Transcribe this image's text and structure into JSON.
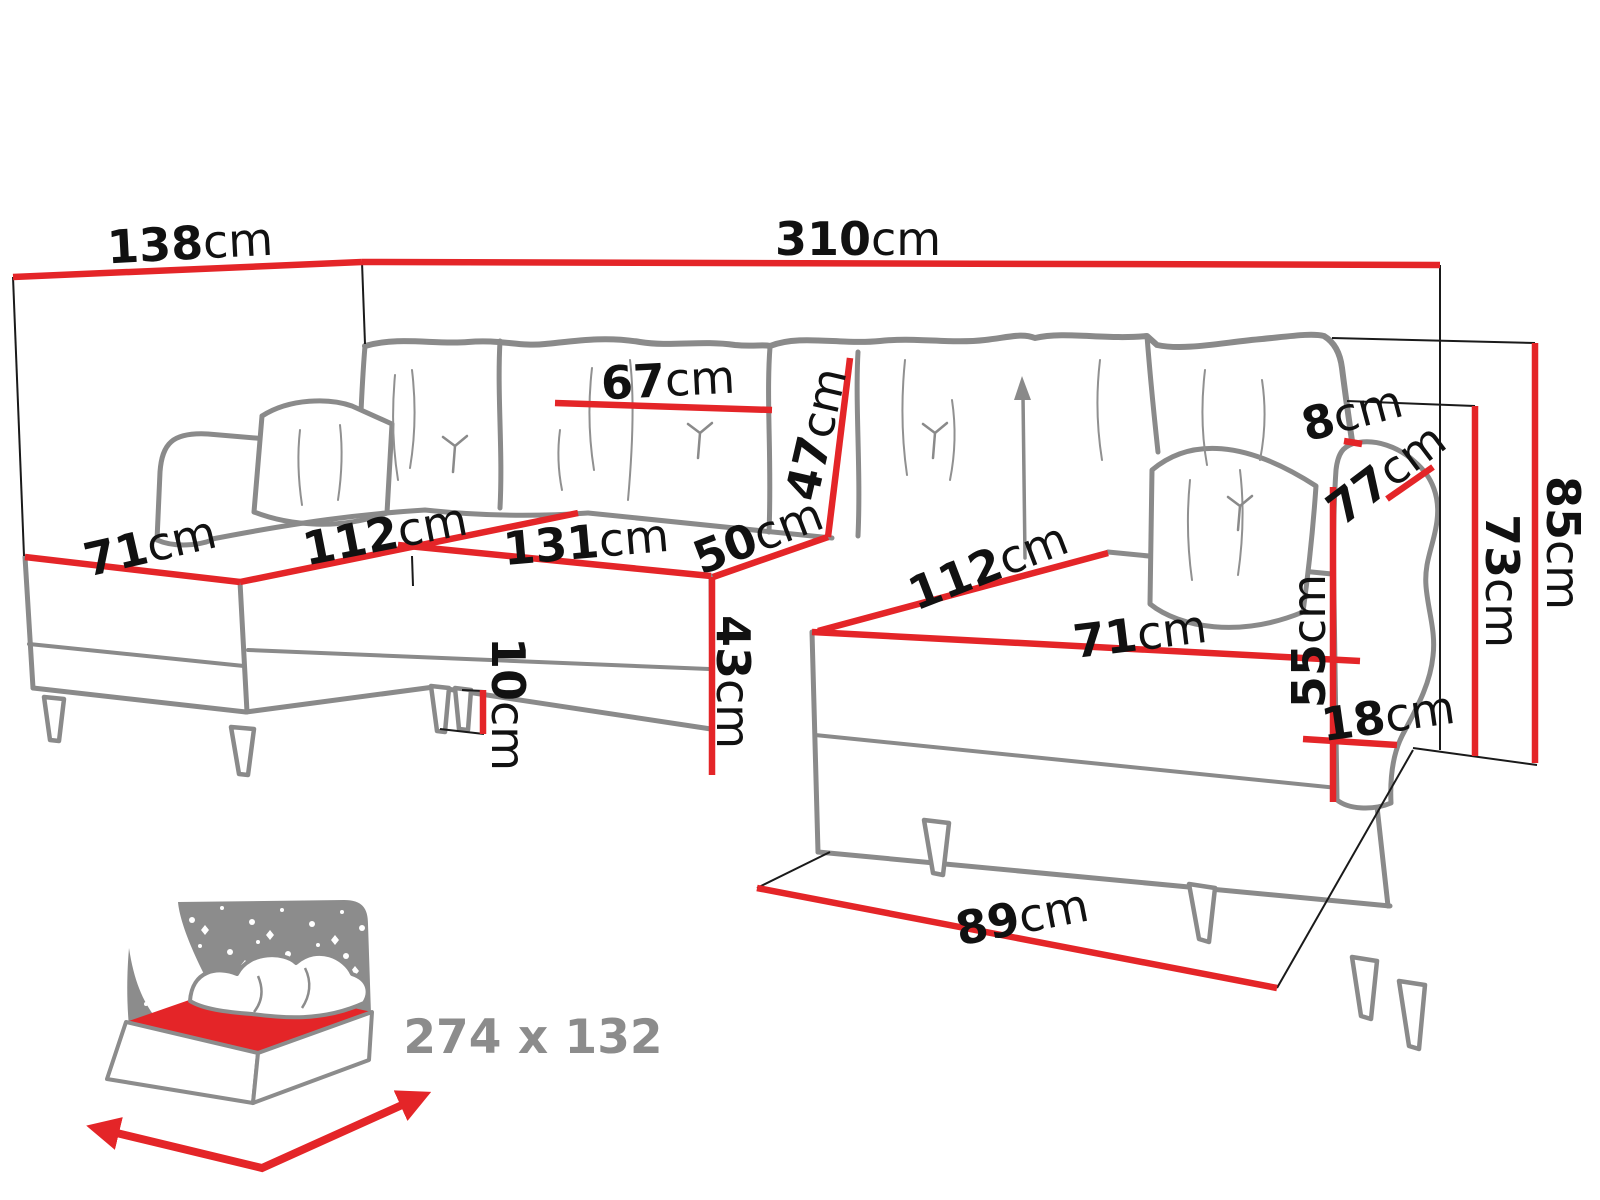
{
  "page": {
    "background": "#ffffff"
  },
  "colors": {
    "red": "#e42528",
    "sofa_gray": "#8a8a8a",
    "label_black": "#111111",
    "icon_gray": "#8c8c8c",
    "thin_black": "#1a1a1a",
    "white": "#ffffff"
  },
  "sleep_icon": {
    "label": "274 x 132"
  },
  "diagram": {
    "label_font_size": 46,
    "labels": [
      {
        "id": "d138",
        "value": "138",
        "unit": "cm",
        "x": 190,
        "y": 243,
        "rot": -3
      },
      {
        "id": "d310",
        "value": "310",
        "unit": "cm",
        "x": 858,
        "y": 239,
        "rot": 0
      },
      {
        "id": "d67",
        "value": "67",
        "unit": "cm",
        "x": 668,
        "y": 380,
        "rot": -3
      },
      {
        "id": "d47",
        "value": "47",
        "unit": "cm",
        "x": 816,
        "y": 434,
        "rot": -77
      },
      {
        "id": "d8",
        "value": "8",
        "unit": "cm",
        "x": 1352,
        "y": 413,
        "rot": -15
      },
      {
        "id": "d77",
        "value": "77",
        "unit": "cm",
        "x": 1386,
        "y": 474,
        "rot": -37
      },
      {
        "id": "d85",
        "value": "85",
        "unit": "cm",
        "x": 1563,
        "y": 543,
        "rot": 90
      },
      {
        "id": "d73",
        "value": "73",
        "unit": "cm",
        "x": 1502,
        "y": 581,
        "rot": 90
      },
      {
        "id": "d55",
        "value": "55",
        "unit": "cm",
        "x": 1309,
        "y": 641,
        "rot": -90
      },
      {
        "id": "d18",
        "value": "18",
        "unit": "cm",
        "x": 1388,
        "y": 716,
        "rot": -8
      },
      {
        "id": "d71-left",
        "value": "71",
        "unit": "cm",
        "x": 150,
        "y": 546,
        "rot": -13
      },
      {
        "id": "d112-left",
        "value": "112",
        "unit": "cm",
        "x": 385,
        "y": 534,
        "rot": -11
      },
      {
        "id": "d131",
        "value": "131",
        "unit": "cm",
        "x": 586,
        "y": 542,
        "rot": -5
      },
      {
        "id": "d50",
        "value": "50",
        "unit": "cm",
        "x": 758,
        "y": 536,
        "rot": -21
      },
      {
        "id": "d43",
        "value": "43",
        "unit": "cm",
        "x": 733,
        "y": 682,
        "rot": 90
      },
      {
        "id": "d10",
        "value": "10",
        "unit": "cm",
        "x": 508,
        "y": 704,
        "rot": 90
      },
      {
        "id": "d112-right",
        "value": "112",
        "unit": "cm",
        "x": 988,
        "y": 566,
        "rot": -21
      },
      {
        "id": "d71-right",
        "value": "71",
        "unit": "cm",
        "x": 1140,
        "y": 634,
        "rot": -7
      },
      {
        "id": "d89",
        "value": "89",
        "unit": "cm",
        "x": 1022,
        "y": 917,
        "rot": -11
      }
    ],
    "red_lines": [
      {
        "id": "l138",
        "x1": 13,
        "y1": 277,
        "x2": 362,
        "y2": 262
      },
      {
        "id": "l310",
        "x1": 362,
        "y1": 262,
        "x2": 1440,
        "y2": 265
      },
      {
        "id": "l85",
        "x1": 1535,
        "y1": 343,
        "x2": 1535,
        "y2": 763
      },
      {
        "id": "l73",
        "x1": 1475,
        "y1": 406,
        "x2": 1475,
        "y2": 756
      },
      {
        "id": "l8",
        "x1": 1344,
        "y1": 441,
        "x2": 1362,
        "y2": 444
      },
      {
        "id": "l77",
        "x1": 1387,
        "y1": 499,
        "x2": 1433,
        "y2": 467
      },
      {
        "id": "l55",
        "x1": 1333,
        "y1": 487,
        "x2": 1333,
        "y2": 802
      },
      {
        "id": "l18",
        "x1": 1303,
        "y1": 739,
        "x2": 1397,
        "y2": 745
      },
      {
        "id": "l71-left",
        "x1": 25,
        "y1": 557,
        "x2": 240,
        "y2": 582
      },
      {
        "id": "l112-left",
        "x1": 240,
        "y1": 582,
        "x2": 578,
        "y2": 513
      },
      {
        "id": "l131",
        "x1": 398,
        "y1": 545,
        "x2": 711,
        "y2": 576
      },
      {
        "id": "l50",
        "x1": 713,
        "y1": 577,
        "x2": 828,
        "y2": 537
      },
      {
        "id": "l47",
        "x1": 850,
        "y1": 358,
        "x2": 828,
        "y2": 537
      },
      {
        "id": "l67",
        "x1": 555,
        "y1": 403,
        "x2": 772,
        "y2": 410
      },
      {
        "id": "l43",
        "x1": 712,
        "y1": 577,
        "x2": 712,
        "y2": 775
      },
      {
        "id": "l10",
        "x1": 483,
        "y1": 690,
        "x2": 483,
        "y2": 734
      },
      {
        "id": "l112-right",
        "x1": 818,
        "y1": 631,
        "x2": 1108,
        "y2": 553
      },
      {
        "id": "l71-right",
        "x1": 812,
        "y1": 632,
        "x2": 1360,
        "y2": 661
      },
      {
        "id": "l89",
        "x1": 757,
        "y1": 888,
        "x2": 1277,
        "y2": 988
      }
    ],
    "thin_lines": [
      {
        "id": "t-left-wall",
        "x1": 13,
        "y1": 277,
        "x2": 24,
        "y2": 556
      },
      {
        "id": "t-split",
        "x1": 362,
        "y1": 262,
        "x2": 365,
        "y2": 344
      },
      {
        "id": "t-right-wall",
        "x1": 1440,
        "y1": 265,
        "x2": 1440,
        "y2": 750
      },
      {
        "id": "t-85-top",
        "x1": 1332,
        "y1": 338,
        "x2": 1535,
        "y2": 343
      },
      {
        "id": "t-73-top",
        "x1": 1347,
        "y1": 401,
        "x2": 1475,
        "y2": 406
      },
      {
        "id": "t-right-bottom",
        "x1": 1413,
        "y1": 748,
        "x2": 1537,
        "y2": 765
      },
      {
        "id": "t-floor-left",
        "x1": 830,
        "y1": 852,
        "x2": 757,
        "y2": 888
      },
      {
        "id": "t-floor-right",
        "x1": 1277,
        "y1": 988,
        "x2": 1413,
        "y2": 750
      },
      {
        "id": "t-leg-bottom",
        "x1": 440,
        "y1": 729,
        "x2": 484,
        "y2": 734
      },
      {
        "id": "t-leg-top",
        "x1": 462,
        "y1": 690,
        "x2": 484,
        "y2": 691
      },
      {
        "id": "t-corner-edge",
        "x1": 412,
        "y1": 556,
        "x2": 413,
        "y2": 586
      }
    ]
  }
}
